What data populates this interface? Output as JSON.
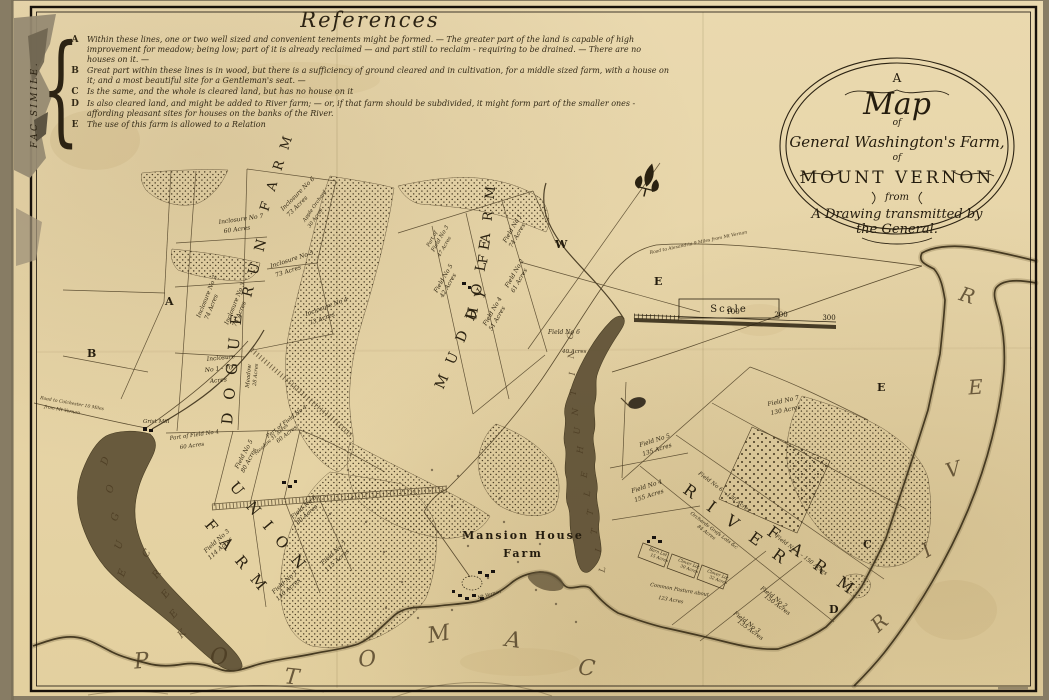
{
  "references": {
    "title": "References",
    "side_label": "FAC SIMILE.",
    "entries": [
      {
        "letter": "A",
        "text": "Within these lines, one or two well sized and convenient tenements might be formed. — The greater part of the land is capable of high improvement for meadow; being low; part of it is already reclaimed — and part still to reclaim - requiring to be drained. — There are no houses on it. —"
      },
      {
        "letter": "B",
        "text": "Great part within these lines is in wood, but there is a sufficiency of ground cleared and in cultivation, for a middle sized farm, with a house on it; and a most beautiful site for a Gentleman's seat. —"
      },
      {
        "letter": "C",
        "text": "Is the same, and the whole is cleared land, but has no house on it"
      },
      {
        "letter": "D",
        "text": "Is also cleared land, and might be added to River farm; — or, if that farm should be subdivided, it might form part of the smaller ones - affording pleasant sites for houses on the banks of the River."
      },
      {
        "letter": "E",
        "text": "The use of this farm is allowed to a Relation"
      }
    ]
  },
  "cartouche": {
    "l1": "A",
    "l2": "Map",
    "l3": "of",
    "l4": "General Washington's Farm,",
    "l5": "of",
    "l6": "MOUNT VERNON",
    "l7": "from",
    "l8": "A Drawing transmitted by",
    "l9": "the General."
  },
  "scale": {
    "label": "Scale",
    "t100": "100",
    "t200": "200",
    "t300": "300"
  },
  "map": {
    "labels": [
      {
        "t": "D O G U E",
        "x": 232,
        "y": 425,
        "r": -85,
        "fs": 15,
        "c": "farm"
      },
      {
        "t": "R U N",
        "x": 251,
        "y": 298,
        "r": -75,
        "fs": 14,
        "c": "farm"
      },
      {
        "t": "F A R M",
        "x": 268,
        "y": 212,
        "r": -72,
        "fs": 13,
        "c": "farm"
      },
      {
        "t": "M U D D Y",
        "x": 443,
        "y": 390,
        "r": -66,
        "fs": 14,
        "c": "farm"
      },
      {
        "t": "H O L E",
        "x": 476,
        "y": 320,
        "r": -80,
        "fs": 14,
        "c": "farm"
      },
      {
        "t": "F A R M",
        "x": 487,
        "y": 264,
        "r": -84,
        "fs": 13,
        "c": "farm"
      },
      {
        "t": "U N I O N",
        "x": 229,
        "y": 487,
        "r": 50,
        "fs": 15,
        "c": "farm"
      },
      {
        "t": "F A R M",
        "x": 204,
        "y": 525,
        "r": 50,
        "fs": 15,
        "c": "farm"
      },
      {
        "t": "R I V E R",
        "x": 682,
        "y": 492,
        "r": 36,
        "fs": 16,
        "c": "farm",
        "ls": 6
      },
      {
        "t": "F A R M",
        "x": 766,
        "y": 534,
        "r": 36,
        "fs": 16,
        "c": "farm",
        "ls": 6
      },
      {
        "t": "Mansion House",
        "x": 523,
        "y": 539,
        "r": 0,
        "fs": 11,
        "c": "mansion",
        "a": "m"
      },
      {
        "t": "Farm",
        "x": 523,
        "y": 557,
        "r": 0,
        "fs": 11,
        "c": "mansion",
        "a": "m"
      },
      {
        "t": "A",
        "x": 165,
        "y": 305,
        "r": 0,
        "c": "ref"
      },
      {
        "t": "B",
        "x": 87,
        "y": 357,
        "r": 0,
        "c": "ref"
      },
      {
        "t": "W",
        "x": 555,
        "y": 248,
        "r": 0,
        "c": "ref"
      },
      {
        "t": "E",
        "x": 654,
        "y": 285,
        "r": 0,
        "c": "ref"
      },
      {
        "t": "E",
        "x": 877,
        "y": 391,
        "r": 0,
        "c": "ref"
      },
      {
        "t": "C",
        "x": 863,
        "y": 548,
        "r": 0,
        "c": "ref"
      },
      {
        "t": "D",
        "x": 829,
        "y": 613,
        "r": 0,
        "c": "ref"
      },
      {
        "t": "P",
        "x": 142,
        "y": 668,
        "r": -5,
        "fs": 22,
        "c": "water",
        "a": "m"
      },
      {
        "t": "O",
        "x": 219,
        "y": 664,
        "r": 0,
        "fs": 22,
        "c": "water",
        "a": "m"
      },
      {
        "t": "T",
        "x": 291,
        "y": 684,
        "r": 6,
        "fs": 22,
        "c": "water",
        "a": "m"
      },
      {
        "t": "O",
        "x": 368,
        "y": 666,
        "r": -6,
        "fs": 22,
        "c": "water",
        "a": "m"
      },
      {
        "t": "M",
        "x": 440,
        "y": 641,
        "r": -10,
        "fs": 22,
        "c": "water",
        "a": "m"
      },
      {
        "t": "A",
        "x": 512,
        "y": 647,
        "r": 8,
        "fs": 22,
        "c": "water",
        "a": "m"
      },
      {
        "t": "C",
        "x": 586,
        "y": 675,
        "r": 6,
        "fs": 22,
        "c": "water",
        "a": "m"
      },
      {
        "t": "R",
        "x": 884,
        "y": 628,
        "r": -42,
        "fs": 20,
        "c": "water",
        "a": "m"
      },
      {
        "t": "I",
        "x": 930,
        "y": 556,
        "r": -30,
        "fs": 20,
        "c": "water",
        "a": "m"
      },
      {
        "t": "V",
        "x": 955,
        "y": 476,
        "r": -16,
        "fs": 20,
        "c": "water",
        "a": "m"
      },
      {
        "t": "E",
        "x": 976,
        "y": 394,
        "r": -4,
        "fs": 20,
        "c": "water",
        "a": "m"
      },
      {
        "t": "R",
        "x": 965,
        "y": 302,
        "r": 18,
        "fs": 20,
        "c": "water",
        "a": "m"
      },
      {
        "t": "D",
        "x": 108,
        "y": 462,
        "r": -70,
        "fs": 10,
        "c": "water",
        "a": "m"
      },
      {
        "t": "O",
        "x": 113,
        "y": 490,
        "r": -70,
        "fs": 10,
        "c": "water",
        "a": "m"
      },
      {
        "t": "G",
        "x": 118,
        "y": 518,
        "r": -70,
        "fs": 10,
        "c": "water",
        "a": "m"
      },
      {
        "t": "U",
        "x": 122,
        "y": 546,
        "r": -70,
        "fs": 10,
        "c": "water",
        "a": "m"
      },
      {
        "t": "E",
        "x": 125,
        "y": 574,
        "r": -70,
        "fs": 10,
        "c": "water",
        "a": "m"
      },
      {
        "t": "C",
        "x": 149,
        "y": 555,
        "r": -55,
        "fs": 10,
        "c": "water",
        "a": "m"
      },
      {
        "t": "R",
        "x": 159,
        "y": 576,
        "r": -52,
        "fs": 10,
        "c": "water",
        "a": "m"
      },
      {
        "t": "E",
        "x": 168,
        "y": 596,
        "r": -50,
        "fs": 10,
        "c": "water",
        "a": "m"
      },
      {
        "t": "E",
        "x": 176,
        "y": 616,
        "r": -48,
        "fs": 10,
        "c": "water",
        "a": "m"
      },
      {
        "t": "K",
        "x": 184,
        "y": 636,
        "r": -45,
        "fs": 10,
        "c": "water",
        "a": "m"
      },
      {
        "t": "L",
        "x": 605,
        "y": 570,
        "r": -80,
        "fs": 8.5,
        "c": "water",
        "a": "m"
      },
      {
        "t": "I",
        "x": 601,
        "y": 551,
        "r": -80,
        "fs": 8.5,
        "c": "water",
        "a": "m"
      },
      {
        "t": "T",
        "x": 597,
        "y": 532,
        "r": -80,
        "fs": 8.5,
        "c": "water",
        "a": "m"
      },
      {
        "t": "T",
        "x": 593,
        "y": 513,
        "r": -80,
        "fs": 8.5,
        "c": "water",
        "a": "m"
      },
      {
        "t": "L",
        "x": 590,
        "y": 494,
        "r": -81,
        "fs": 8.5,
        "c": "water",
        "a": "m"
      },
      {
        "t": "E",
        "x": 587,
        "y": 475,
        "r": -82,
        "fs": 8.5,
        "c": "water",
        "a": "m"
      },
      {
        "t": "H",
        "x": 583,
        "y": 450,
        "r": -84,
        "fs": 8.5,
        "c": "water",
        "a": "m"
      },
      {
        "t": "U",
        "x": 580,
        "y": 431,
        "r": -85,
        "fs": 8.5,
        "c": "water",
        "a": "m"
      },
      {
        "t": "N",
        "x": 578,
        "y": 412,
        "r": -85,
        "fs": 8.5,
        "c": "water",
        "a": "m"
      },
      {
        "t": "T",
        "x": 576,
        "y": 393,
        "r": -86,
        "fs": 8.5,
        "c": "water",
        "a": "m"
      },
      {
        "t": "I",
        "x": 575,
        "y": 374,
        "r": -86,
        "fs": 8.5,
        "c": "water",
        "a": "m"
      },
      {
        "t": "N",
        "x": 574,
        "y": 355,
        "r": -87,
        "fs": 8.5,
        "c": "water",
        "a": "m"
      },
      {
        "t": "G",
        "x": 573,
        "y": 336,
        "r": -87,
        "fs": 8.5,
        "c": "water",
        "a": "m"
      },
      {
        "t": "Inclosure No 7",
        "x": 219,
        "y": 224,
        "r": -8
      },
      {
        "t": "60 Acres",
        "x": 224,
        "y": 233,
        "r": -8
      },
      {
        "t": "Inclosure No 6",
        "x": 283,
        "y": 211,
        "r": -45
      },
      {
        "t": "73 Acres",
        "x": 289,
        "y": 217,
        "r": -45
      },
      {
        "t": "Apple Orchard",
        "x": 305,
        "y": 222,
        "r": -55,
        "fs": 5
      },
      {
        "t": "30 Acres",
        "x": 310,
        "y": 228,
        "r": -55,
        "fs": 5
      },
      {
        "t": "Inclosure No 5",
        "x": 271,
        "y": 268,
        "r": -18
      },
      {
        "t": "73 Acres",
        "x": 276,
        "y": 277,
        "r": -18
      },
      {
        "t": "Inclosure No 4",
        "x": 306,
        "y": 316,
        "r": -20
      },
      {
        "t": "73 Acres",
        "x": 310,
        "y": 325,
        "r": -20
      },
      {
        "t": "Inclosure No 2",
        "x": 200,
        "y": 318,
        "r": -68
      },
      {
        "t": "74 Acres",
        "x": 208,
        "y": 320,
        "r": -68
      },
      {
        "t": "Inclosure No 3",
        "x": 228,
        "y": 325,
        "r": -68
      },
      {
        "t": "74 Acres",
        "x": 236,
        "y": 327,
        "r": -68
      },
      {
        "t": "Inclosure",
        "x": 207,
        "y": 361,
        "r": -6
      },
      {
        "t": "No 1 - 70",
        "x": 205,
        "y": 372,
        "r": -6
      },
      {
        "t": "Acres",
        "x": 210,
        "y": 383,
        "r": -6
      },
      {
        "t": "Meadow",
        "x": 249,
        "y": 388,
        "r": -85,
        "fs": 5.5
      },
      {
        "t": "28 Acres",
        "x": 256,
        "y": 386,
        "r": -85,
        "fs": 5
      },
      {
        "t": "Field No 1",
        "x": 506,
        "y": 243,
        "r": -60
      },
      {
        "t": "74 Acres",
        "x": 512,
        "y": 248,
        "r": -60
      },
      {
        "t": "Part of",
        "x": 429,
        "y": 247,
        "r": -60,
        "fs": 5
      },
      {
        "t": "Field No 3",
        "x": 434,
        "y": 252,
        "r": -60,
        "fs": 5.5
      },
      {
        "t": "47 Acres",
        "x": 440,
        "y": 257,
        "r": -60,
        "fs": 5
      },
      {
        "t": "Field No 2",
        "x": 508,
        "y": 288,
        "r": -60
      },
      {
        "t": "61 Acres",
        "x": 514,
        "y": 293,
        "r": -60
      },
      {
        "t": "Field No 5",
        "x": 437,
        "y": 293,
        "r": -60
      },
      {
        "t": "42 Acres",
        "x": 443,
        "y": 298,
        "r": -60
      },
      {
        "t": "Field No 4",
        "x": 486,
        "y": 326,
        "r": -60
      },
      {
        "t": "51 Acres",
        "x": 492,
        "y": 331,
        "r": -60
      },
      {
        "t": "Field No 6",
        "x": 548,
        "y": 334,
        "r": 0
      },
      {
        "t": "40 Acres",
        "x": 562,
        "y": 353,
        "r": 0,
        "fs": 5.5
      },
      {
        "t": "Grist Mill",
        "x": 143,
        "y": 423,
        "r": 0,
        "fs": 5.5
      },
      {
        "t": "Part of Field No 4",
        "x": 170,
        "y": 440,
        "r": -8,
        "fs": 5.5
      },
      {
        "t": "60 Acres",
        "x": 180,
        "y": 449,
        "r": -8,
        "fs": 5.5
      },
      {
        "t": "Part of Field No 4",
        "x": 268,
        "y": 438,
        "r": -38,
        "fs": 5.5
      },
      {
        "t": "60 Acres",
        "x": 278,
        "y": 443,
        "r": -38,
        "fs": 5.5
      },
      {
        "t": "Field No 5",
        "x": 238,
        "y": 469,
        "r": -62
      },
      {
        "t": "80 Acres",
        "x": 244,
        "y": 473,
        "r": -62
      },
      {
        "t": "Meadow 31 Acres",
        "x": 256,
        "y": 455,
        "r": -42,
        "fs": 4.8
      },
      {
        "t": "Field No 6",
        "x": 293,
        "y": 519,
        "r": -42
      },
      {
        "t": "80 Acres",
        "x": 298,
        "y": 525,
        "r": -42
      },
      {
        "t": "Field No 7",
        "x": 323,
        "y": 565,
        "r": -42
      },
      {
        "t": "115 Acres",
        "x": 327,
        "y": 572,
        "r": -42
      },
      {
        "t": "Field No 1",
        "x": 274,
        "y": 594,
        "r": -42
      },
      {
        "t": "110 Acres",
        "x": 278,
        "y": 601,
        "r": -42
      },
      {
        "t": "Field No 3",
        "x": 206,
        "y": 553,
        "r": -42
      },
      {
        "t": "114 Acres",
        "x": 210,
        "y": 560,
        "r": -42
      },
      {
        "t": "Mt Vernon",
        "x": 478,
        "y": 599,
        "r": -15,
        "fs": 4.5
      },
      {
        "t": "Field No 5",
        "x": 640,
        "y": 447,
        "r": -18
      },
      {
        "t": "135 Acres",
        "x": 643,
        "y": 456,
        "r": -18
      },
      {
        "t": "Field No 4",
        "x": 632,
        "y": 493,
        "r": -18
      },
      {
        "t": "155 Acres",
        "x": 635,
        "y": 502,
        "r": -18
      },
      {
        "t": "Common Pasture about",
        "x": 650,
        "y": 586,
        "r": 10,
        "fs": 5
      },
      {
        "t": "123 Acres",
        "x": 658,
        "y": 599,
        "r": 10,
        "fs": 5
      },
      {
        "t": "Field No 7",
        "x": 768,
        "y": 406,
        "r": -12
      },
      {
        "t": "130 Acres",
        "x": 771,
        "y": 415,
        "r": -12
      },
      {
        "t": "Field No 6 – 130 Acres",
        "x": 698,
        "y": 474,
        "r": 37,
        "fs": 5.5
      },
      {
        "t": "Field No 1 – 150 Acres",
        "x": 775,
        "y": 537,
        "r": 37,
        "fs": 5.5
      },
      {
        "t": "Orchards Grafs Lots &c",
        "x": 690,
        "y": 514,
        "r": 37,
        "fs": 4.8
      },
      {
        "t": "84 Acres",
        "x": 697,
        "y": 527,
        "r": 37,
        "fs": 4.8
      },
      {
        "t": "Barn Lot",
        "x": 649,
        "y": 550,
        "r": 20,
        "fs": 4.2
      },
      {
        "t": "15 Acres",
        "x": 650,
        "y": 556,
        "r": 20,
        "fs": 4.2
      },
      {
        "t": "Clover Lot",
        "x": 678,
        "y": 561,
        "r": 20,
        "fs": 4.2
      },
      {
        "t": "30 Acres",
        "x": 680,
        "y": 567,
        "r": 20,
        "fs": 4.2
      },
      {
        "t": "Clover Lot",
        "x": 707,
        "y": 572,
        "r": 20,
        "fs": 4.2
      },
      {
        "t": "32 Acres",
        "x": 709,
        "y": 578,
        "r": 20,
        "fs": 4.2
      },
      {
        "t": "Field No 2",
        "x": 760,
        "y": 589,
        "r": 37
      },
      {
        "t": "150 Acres",
        "x": 764,
        "y": 597,
        "r": 37
      },
      {
        "t": "Field No 3",
        "x": 733,
        "y": 614,
        "r": 37
      },
      {
        "t": "135 Acres",
        "x": 737,
        "y": 622,
        "r": 37
      },
      {
        "t": "Road to Alexandria 9 Miles from Mt Vernon",
        "x": 650,
        "y": 254,
        "r": -12,
        "fs": 4.5,
        "c": "road"
      },
      {
        "t": "Road to Colchester 10 Miles",
        "x": 40,
        "y": 399,
        "r": 10,
        "fs": 4.5,
        "c": "road"
      },
      {
        "t": "from Mt Vernon",
        "x": 44,
        "y": 408,
        "r": 10,
        "fs": 4.5,
        "c": "road"
      }
    ]
  }
}
